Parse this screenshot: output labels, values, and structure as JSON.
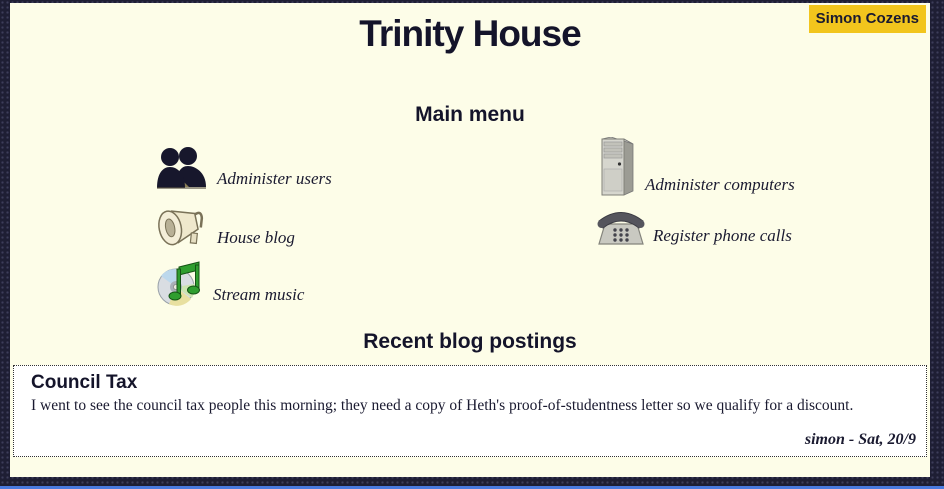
{
  "page": {
    "title": "Trinity House",
    "user_badge": "Simon Cozens"
  },
  "main_menu": {
    "heading": "Main menu",
    "left_items": [
      {
        "label": "Administer users",
        "icon": "users-icon"
      },
      {
        "label": "House blog",
        "icon": "megaphone-icon"
      },
      {
        "label": "Stream music",
        "icon": "cd-music-icon"
      }
    ],
    "right_items": [
      {
        "label": "Administer computers",
        "icon": "computer-tower-icon"
      },
      {
        "label": "Register phone calls",
        "icon": "telephone-icon"
      }
    ]
  },
  "blog": {
    "heading": "Recent blog postings",
    "posts": [
      {
        "title": "Council Tax",
        "body": "I went to see the council tax people this morning; they need a copy of Heth's proof-of-studentness letter so we qualify for a discount.",
        "signature": "simon - Sat, 20/9"
      }
    ]
  },
  "colors": {
    "outer_background": "#1e1e34",
    "content_background": "#fdfde8",
    "text": "#1a1a30",
    "badge_background": "#f2c51d",
    "post_background": "#ffffff",
    "bottom_edge": "#4a7ae0"
  }
}
